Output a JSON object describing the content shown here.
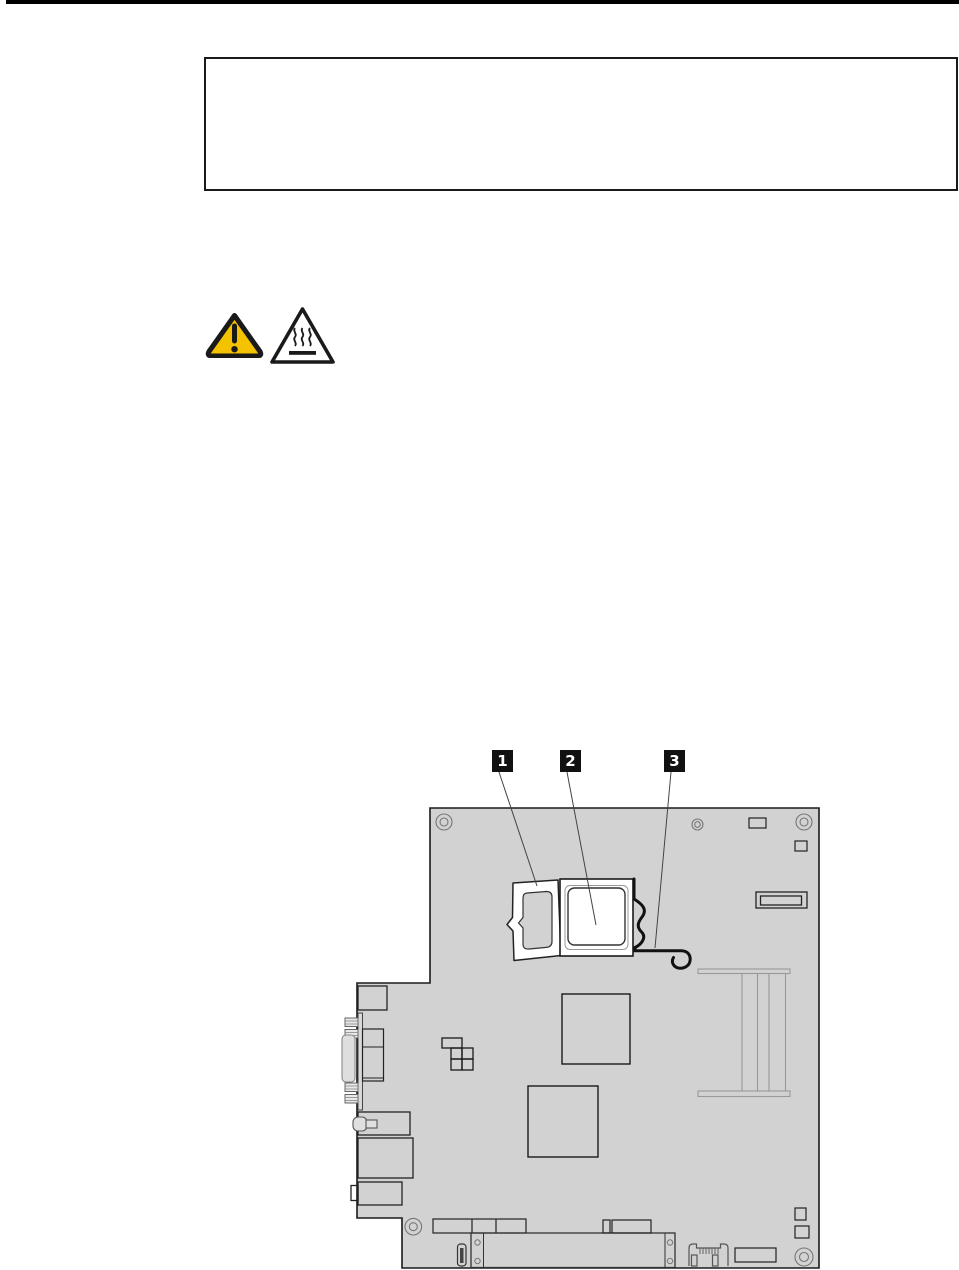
{
  "page": {
    "background": "#ffffff",
    "header_rule_color": "#000000"
  },
  "notice_box": {
    "content": ""
  },
  "safety": {
    "icons": [
      {
        "name": "caution-exclamation-triangle",
        "fill": "#f3c300"
      },
      {
        "name": "hot-surface-triangle",
        "fill": "#ffffff"
      }
    ]
  },
  "diagram": {
    "type": "system-board-line-drawing",
    "board_fill": "#d2d2d2",
    "outline_color": "#1a1a1a",
    "callout_bg": "#111111",
    "callout_fg": "#ffffff",
    "callouts": [
      {
        "label": "1"
      },
      {
        "label": "2"
      },
      {
        "label": "3"
      }
    ]
  }
}
